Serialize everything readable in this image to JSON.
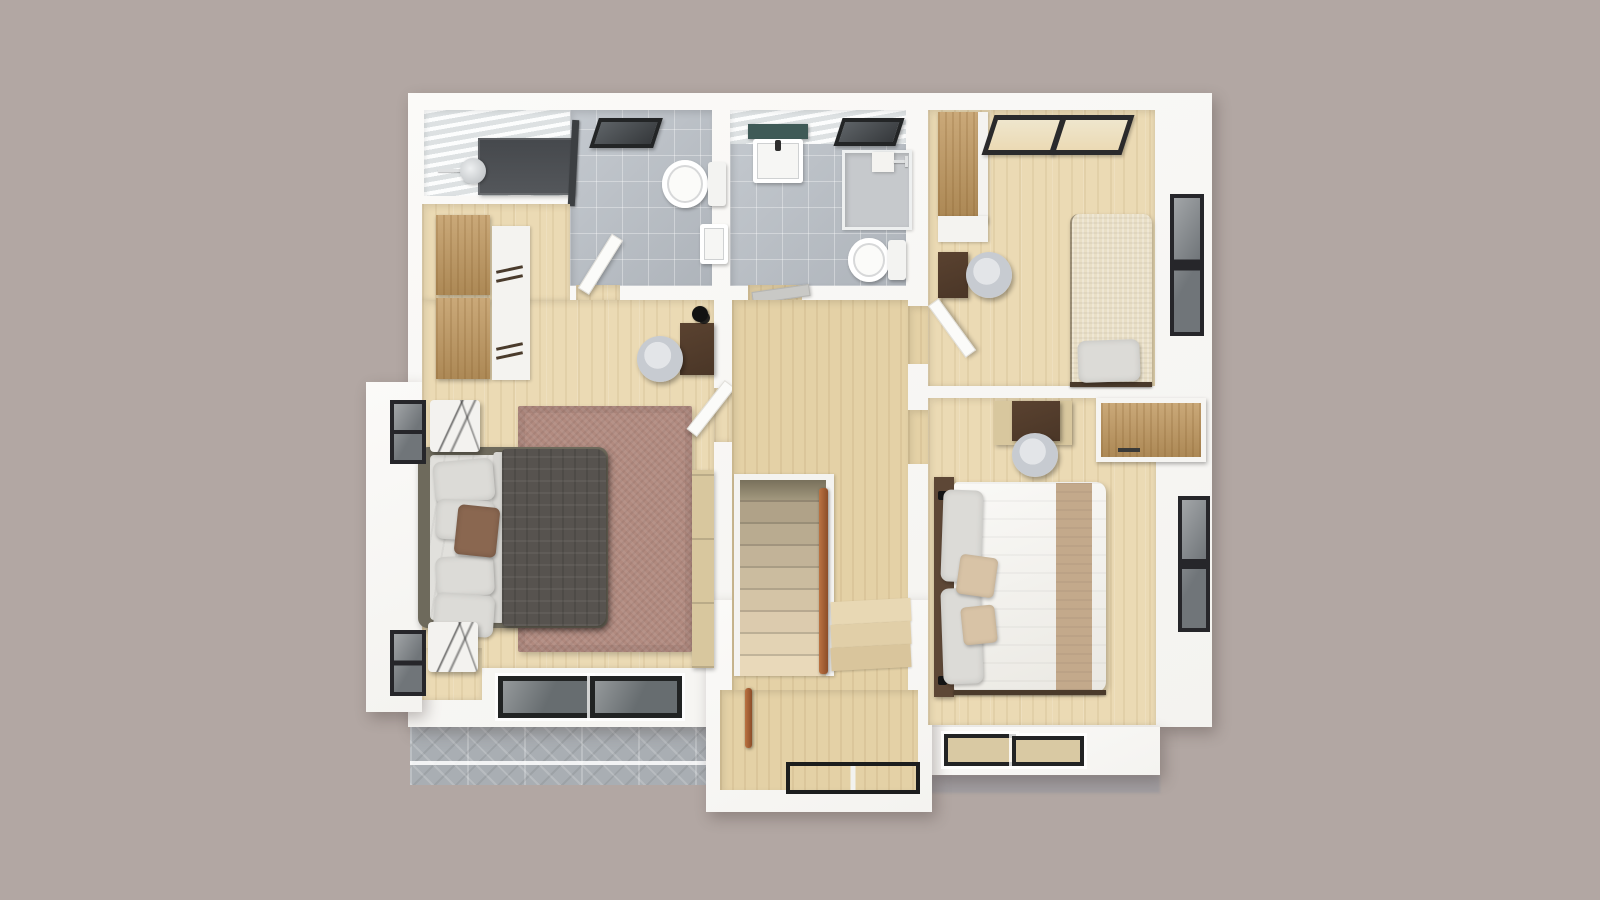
{
  "scene": {
    "name": "second-floor-3d-floor-plan-render",
    "view": "top-down-dollhouse",
    "building": {
      "exterior": "white-render-walls",
      "lower_roof_section": "grey-tiles",
      "stair_bay": "protruding-south-bay"
    },
    "rooms": [
      {
        "name": "bathroom-1",
        "floor": "grey-tile",
        "items": [
          "walk-in-shower",
          "shower-head",
          "glass-partition",
          "skylight",
          "toilet",
          "wall-sink",
          "door-to-master-bedroom"
        ]
      },
      {
        "name": "bathroom-2",
        "floor": "grey-tile",
        "items": [
          "vanity-counter",
          "wall-sink-cabinet",
          "skylight",
          "shower-enclosure",
          "shower-arm",
          "toilet",
          "door-to-hallway"
        ]
      },
      {
        "name": "master-bedroom",
        "floor": "light-wood",
        "items": [
          "wardrobe-tan",
          "dresser-white",
          "desk",
          "desk-lamp",
          "desk-chair",
          "double-bed",
          "dark-duvet",
          "white-pillows",
          "accent-pillow",
          "area-rug",
          "nightstand-north",
          "nightstand-south",
          "window-west-north",
          "window-west-south",
          "low-bay-windows-south",
          "console-shelf",
          "door-to-hallway"
        ]
      },
      {
        "name": "kids-bedroom",
        "floor": "light-wood",
        "items": [
          "wardrobe-tan",
          "desk",
          "desk-chair",
          "single-bed",
          "cream-blanket",
          "white-pillow",
          "clerestory-windows-north",
          "window-east",
          "door-to-hallway"
        ]
      },
      {
        "name": "bedroom-2",
        "floor": "light-wood",
        "items": [
          "desk",
          "desk-chair",
          "built-in-wardrobe",
          "double-bed",
          "white-duvet",
          "tan-runner",
          "white-pillows",
          "tan-pillows",
          "dark-headboard",
          "window-east",
          "low-windows-south",
          "door-to-hallway"
        ]
      },
      {
        "name": "hallway-landing",
        "floor": "light-wood",
        "items": [
          "staircase-down",
          "stair-handrail",
          "winder-steps",
          "lower-flight-rail",
          "stair-bay-window"
        ]
      }
    ],
    "colors": {
      "background": "#b2a7a3",
      "wall": "#f4f3f0",
      "wood_floor": "#ebdab4",
      "wood_floor_hall": "#e4d1a6",
      "tile_floor": "#b9bfc6",
      "ceiling": "#edf0f1",
      "roof_grey": "#a9aeb3",
      "shadow_grey": "#a19da0",
      "shower_dark": "#54575b",
      "counter_teal": "#3f5a57",
      "rug": "#b18a7f",
      "duvet_dark": "#57534f",
      "bed_frame_olive": "#6e6a5c",
      "sheet": "#e1e0dc",
      "pillow": "#dcdbd7",
      "pillow_accent": "#8a6750",
      "marble": "#f3f2ef",
      "tan_wood": "#c0985f",
      "desk_dark": "#4a3627",
      "chair_grey": "#c7cbd1",
      "chair_grey_light": "#e3e5e8",
      "handrail": "#8c4d28",
      "window_frame": "#26262a",
      "window_glass": "#707579",
      "duvet_white": "#f2f0ea",
      "runner_tan": "#c3a98b",
      "headboard_brown": "#5d4736",
      "blanket_cream": "#e9dfc6",
      "console_tan": "#d8c79e",
      "door_leaf": "#fbfbf9"
    }
  }
}
